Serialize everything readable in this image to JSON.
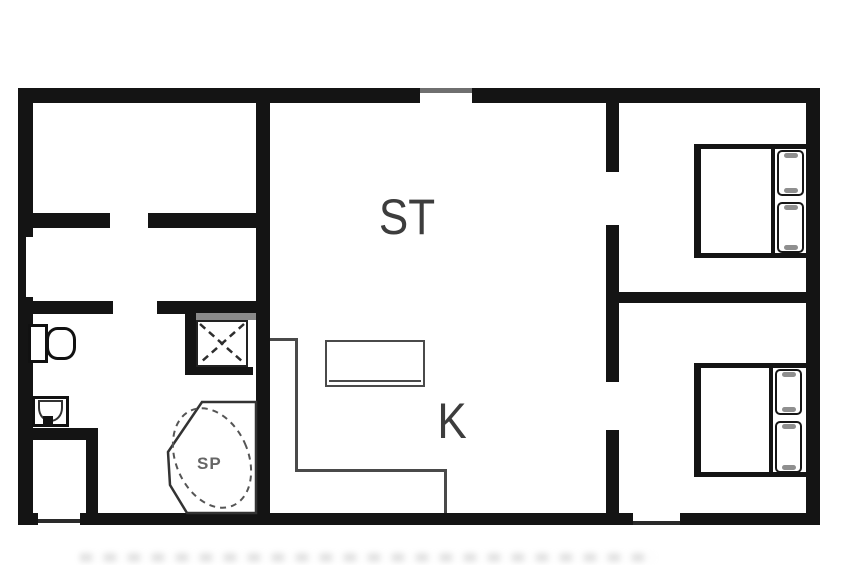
{
  "floorplan": {
    "labels": {
      "living": "ST",
      "kitchen": "K",
      "spa": "SP"
    },
    "colors": {
      "wall": "#141414",
      "thin_line": "#4a4a4a",
      "label_text": "#3d3d3d",
      "spa_text": "#666666",
      "pillow_accent": "#8f8f8f",
      "background": "#ffffff"
    },
    "fixtures": [
      "toilet",
      "sink",
      "shower",
      "spa-tub",
      "kitchen-counter",
      "closet",
      "double-bed-top",
      "double-bed-bottom"
    ]
  }
}
